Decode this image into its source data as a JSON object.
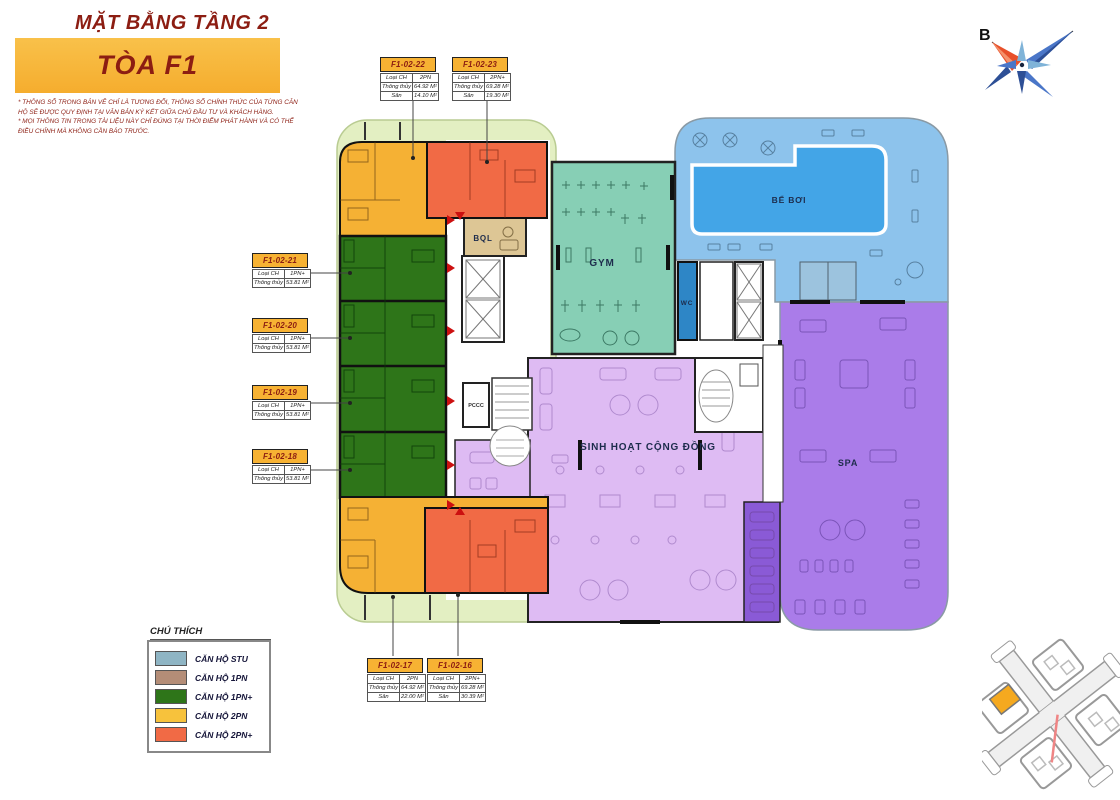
{
  "header": {
    "title": "MẶT BẰNG TẦNG 2",
    "tower": "TÒA F1",
    "disclaimer_line1": "* THÔNG SỐ TRONG BẢN VẼ CHỈ LÀ TƯƠNG ĐỐI, THÔNG SỐ CHÍNH THỨC CỦA TỪNG CĂN HỘ SẼ ĐƯỢC QUY ĐỊNH TẠI VĂN BẢN KÝ KẾT GIỮA CHỦ ĐẦU TƯ VÀ KHÁCH HÀNG.",
    "disclaimer_line2": "* MỌI THÔNG TIN TRONG TÀI LIỆU NÀY CHỈ ĐÚNG TẠI THỜI ĐIỂM PHÁT HÀNH VÀ CÓ THỂ ĐIỀU CHỈNH MÀ KHÔNG CẦN BÁO TRƯỚC."
  },
  "compass": {
    "north_label": "B"
  },
  "plan": {
    "rooms": {
      "bql": "BQL",
      "gym": "GYM",
      "wc": "WC",
      "pccc": "PCCC",
      "pool": "BỂ BƠI",
      "community": "SINH HOẠT CỘNG ĐỒNG",
      "spa": "SPA"
    },
    "colors": {
      "unit_stu": "#8fb5c4",
      "unit_1pn": "#b48d77",
      "unit_1pn_plus": "#2e7519",
      "unit_2pn": "#f5b134",
      "unit_2pn_plus": "#f16a45",
      "balcony": "#e3efc2",
      "pool_deck": "#8dc3ec",
      "pool_water": "#43a5e7",
      "wc": "#2e86c6",
      "gym": "#87cfb5",
      "community": "#debbf3",
      "spa": "#aa7ce9",
      "spa_dark": "#8a5ad6",
      "bql": "#ddc695",
      "marker_red": "#cc1010"
    }
  },
  "units": [
    {
      "id": "F1-02-22",
      "rows": [
        [
          "Loại CH",
          "2PN"
        ],
        [
          "Thông thủy",
          "64.92 M²"
        ],
        [
          "Sân",
          "14.10 M²"
        ]
      ]
    },
    {
      "id": "F1-02-23",
      "rows": [
        [
          "Loại CH",
          "2PN+"
        ],
        [
          "Thông thủy",
          "69.28 M²"
        ],
        [
          "Sân",
          "19.30 M²"
        ]
      ]
    },
    {
      "id": "F1-02-21",
      "rows": [
        [
          "Loại CH",
          "1PN+"
        ],
        [
          "Thông thủy",
          "53.81 M²"
        ]
      ]
    },
    {
      "id": "F1-02-20",
      "rows": [
        [
          "Loại CH",
          "1PN+"
        ],
        [
          "Thông thủy",
          "53.81 M²"
        ]
      ]
    },
    {
      "id": "F1-02-19",
      "rows": [
        [
          "Loại CH",
          "1PN+"
        ],
        [
          "Thông thủy",
          "53.81 M²"
        ]
      ]
    },
    {
      "id": "F1-02-18",
      "rows": [
        [
          "Loại CH",
          "1PN+"
        ],
        [
          "Thông thủy",
          "53.81 M²"
        ]
      ]
    },
    {
      "id": "F1-02-17",
      "rows": [
        [
          "Loại CH",
          "2PN"
        ],
        [
          "Thông thủy",
          "64.92 M²"
        ],
        [
          "Sân",
          "22.00 M²"
        ]
      ]
    },
    {
      "id": "F1-02-16",
      "rows": [
        [
          "Loại CH",
          "2PN+"
        ],
        [
          "Thông thủy",
          "69.28 M²"
        ],
        [
          "Sân",
          "30.39 M²"
        ]
      ]
    }
  ],
  "legend": {
    "title": "CHÚ THÍCH",
    "items": [
      {
        "label": "CĂN HỘ STU",
        "color": "#8fb5c4"
      },
      {
        "label": "CĂN HỘ 1PN",
        "color": "#b48d77"
      },
      {
        "label": "CĂN HỘ 1PN+",
        "color": "#2e7519"
      },
      {
        "label": "CĂN HỘ 2PN",
        "color": "#f7c23c"
      },
      {
        "label": "CĂN HỘ 2PN+",
        "color": "#f16a45"
      }
    ]
  }
}
